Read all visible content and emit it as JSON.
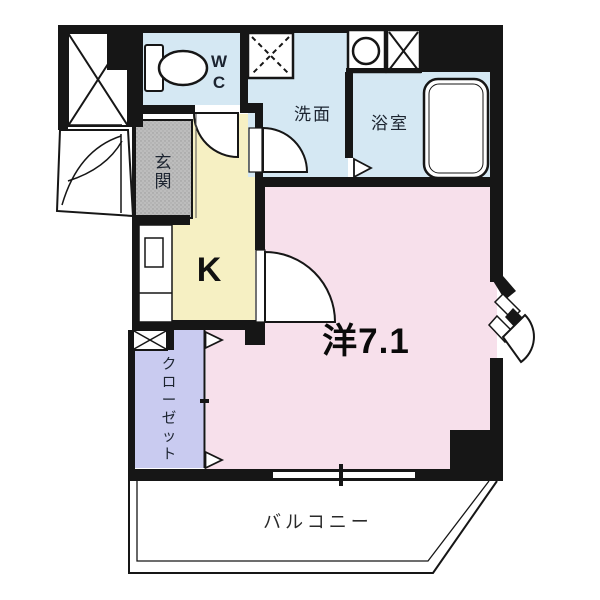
{
  "type": "floorplan",
  "title": "1K apartment floor plan",
  "rooms": {
    "wc": {
      "label": "WC"
    },
    "washroom": {
      "label": "洗面"
    },
    "bathroom": {
      "label": "浴室"
    },
    "entrance": {
      "label": "玄関"
    },
    "kitchen": {
      "label": "K"
    },
    "western_room": {
      "label": "洋7.1"
    },
    "closet": {
      "label": "クローゼット"
    },
    "balcony": {
      "label": "バルコニー"
    }
  },
  "colors": {
    "wall": "#161616",
    "water_rooms": "#d5e8f3",
    "kitchen": "#f6f0c3",
    "western_room": "#f7e0eb",
    "closet": "#c9cbf0",
    "entrance": "#bdbdbd",
    "text": "#1c2430",
    "background": "#ffffff"
  }
}
